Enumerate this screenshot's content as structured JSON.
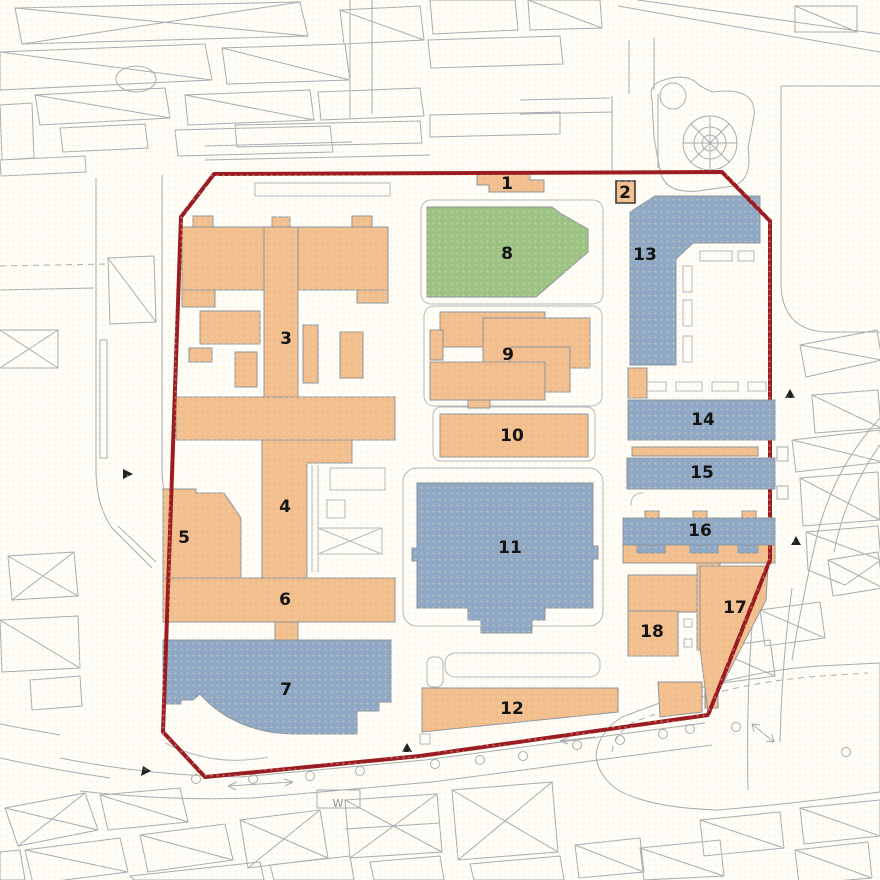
{
  "map": {
    "type": "site-plan",
    "background": "#FEFDF8",
    "colors": {
      "site_boundary": "#9B1B22",
      "building_orange": "#F3BE8D",
      "building_blue": "#8FA8C6",
      "building_green": "#9CC284",
      "building_outline": "#8F959D",
      "building_dark_outline": "#3A3A3A",
      "context_outline": "#A6AAAF",
      "label_text": "#141414",
      "dot_texture": "#EFE6B0"
    },
    "boundary": {
      "points": "214,174 722,172 770,221 770,560 708,715 420,756 205,777 163,732 181,217",
      "stroke_width": 4
    },
    "buildings": [
      {
        "id": "b1",
        "number": "1",
        "category": "orange",
        "label": {
          "x": 507,
          "y": 184
        },
        "shapes": [
          {
            "points": "477,173 530,173 530,180 544,180 544,192 489,192 489,185 477,185"
          }
        ]
      },
      {
        "id": "b2",
        "number": "2",
        "category": "orange",
        "dark_border": true,
        "label": {
          "x": 625,
          "y": 193
        },
        "shapes": [
          {
            "points": "616,181 635,181 635,203 616,203"
          }
        ]
      },
      {
        "id": "b3",
        "number": "3",
        "category": "orange",
        "label": {
          "x": 286,
          "y": 339
        },
        "shapes": [
          {
            "points": "182,227 268,227 268,290 182,290"
          },
          {
            "points": "193,216 213,216 213,227 193,227"
          },
          {
            "points": "298,227 388,227 388,290 298,290"
          },
          {
            "points": "352,216 372,216 372,227 352,227"
          },
          {
            "points": "264,227 298,227 298,398 264,398"
          },
          {
            "points": "272,217 290,217 290,227 272,227"
          },
          {
            "points": "182,290 215,290 215,307 182,307"
          },
          {
            "points": "357,290 388,290 388,303 357,303"
          },
          {
            "points": "200,311 260,311 260,344 200,344"
          },
          {
            "points": "189,348 212,348 212,362 189,362"
          },
          {
            "points": "235,352 257,352 257,387 235,387"
          },
          {
            "points": "303,325 318,325 318,383 303,383"
          },
          {
            "points": "340,332 363,332 363,378 340,378"
          },
          {
            "points": "176,397 395,397 395,440 176,440"
          }
        ]
      },
      {
        "id": "b4",
        "number": "4",
        "category": "orange",
        "label": {
          "x": 285,
          "y": 507
        },
        "shapes": [
          {
            "points": "262,440 352,440 352,463 307,463 307,578 262,578"
          }
        ]
      },
      {
        "id": "b5",
        "number": "5",
        "category": "orange",
        "label": {
          "x": 184,
          "y": 538
        },
        "shapes": [
          {
            "points": "163,489 196,489 196,493 224,493 241,518 241,578 163,578"
          }
        ]
      },
      {
        "id": "b6",
        "number": "6",
        "category": "orange",
        "label": {
          "x": 285,
          "y": 600
        },
        "shapes": [
          {
            "points": "163,578 395,578 395,622 163,622"
          },
          {
            "points": "275,622 298,622 298,641 275,641"
          }
        ]
      },
      {
        "id": "b7",
        "number": "7",
        "category": "blue",
        "label": {
          "x": 286,
          "y": 690
        },
        "shapes": [
          {
            "d": "M163,640 H391 V702 H379 V711 H357 V734 H295 C255,734 222,719 200,694 L193,700 H181 V704 H163 Z"
          }
        ]
      },
      {
        "id": "b8",
        "number": "8",
        "category": "green",
        "label": {
          "x": 507,
          "y": 254
        },
        "shapes": [
          {
            "points": "427,207 552,207 560,213 588,229 588,252 536,297 427,297"
          }
        ]
      },
      {
        "id": "b9",
        "number": "9",
        "category": "orange",
        "label": {
          "x": 508,
          "y": 355
        },
        "shapes": [
          {
            "points": "440,312 545,312 545,347 440,347"
          },
          {
            "points": "483,318 590,318 590,368 483,368"
          },
          {
            "points": "510,347 570,347 570,392 510,392"
          },
          {
            "points": "430,362 545,362 545,400 430,400"
          },
          {
            "points": "430,330 443,330 443,360 430,360"
          },
          {
            "points": "468,400 490,400 490,408 468,408"
          }
        ]
      },
      {
        "id": "b10",
        "number": "10",
        "category": "orange",
        "label": {
          "x": 512,
          "y": 436
        },
        "shapes": [
          {
            "points": "440,414 588,414 588,457 440,457"
          }
        ]
      },
      {
        "id": "b11",
        "number": "11",
        "category": "blue",
        "label": {
          "x": 510,
          "y": 548
        },
        "shapes": [
          {
            "d": "M417,483 H593 V546 H598 V559 H593 V608 H545 V620 H532 V633 H481 V620 H468 V608 H417 V561 H412 V548 H417 Z"
          }
        ]
      },
      {
        "id": "b12",
        "number": "12",
        "category": "orange",
        "label": {
          "x": 512,
          "y": 709
        },
        "shapes": [
          {
            "points": "422,688 618,688 618,712 422,732"
          },
          {
            "points": "658,682 702,682 702,712 660,717"
          },
          {
            "points": "705,689 718,689 718,708 705,708"
          }
        ]
      },
      {
        "id": "b13",
        "number": "13",
        "category": "blue",
        "label": {
          "x": 645,
          "y": 255
        },
        "shapes": [
          {
            "d": "M630,212 L655,196 H760 V243 H693 L676,259 V365 H630 Z"
          }
        ]
      },
      {
        "id": "b14",
        "number": "14",
        "category": "blue",
        "layer": "over",
        "label": {
          "x": 703,
          "y": 420
        },
        "shapes": [
          {
            "points": "628,400 775,400 775,440 628,440"
          }
        ]
      },
      {
        "id": "strip-14-15",
        "category": "orange",
        "shapes": [
          {
            "points": "632,447 758,447 758,456 632,456"
          }
        ]
      },
      {
        "id": "b15",
        "number": "15",
        "category": "blue",
        "layer": "over",
        "label": {
          "x": 702,
          "y": 473
        },
        "shapes": [
          {
            "points": "627,458 775,458 775,489 627,489"
          }
        ]
      },
      {
        "id": "tabs-above-16",
        "category": "orange",
        "shapes": [
          {
            "points": "645,511 659,511 659,518 645,518"
          },
          {
            "points": "693,511 707,511 707,518 693,518"
          },
          {
            "points": "742,511 756,511 756,518 742,518"
          }
        ]
      },
      {
        "id": "strip-below-16",
        "category": "orange",
        "shapes": [
          {
            "points": "623,545 775,545 775,563 623,563"
          }
        ]
      },
      {
        "id": "b16",
        "number": "16",
        "category": "blue",
        "layer": "over",
        "label": {
          "x": 700,
          "y": 531
        },
        "shapes": [
          {
            "points": "623,518 775,518 775,545 623,545"
          },
          {
            "points": "637,545 665,545 665,553 637,553"
          },
          {
            "points": "690,545 718,545 718,553 690,553"
          },
          {
            "points": "738,545 758,545 758,553 738,553"
          }
        ]
      },
      {
        "id": "patch-left-of-14",
        "category": "orange",
        "shapes": [
          {
            "points": "628,368 647,368 647,398 628,398"
          }
        ]
      },
      {
        "id": "b17",
        "number": "17",
        "category": "orange",
        "label": {
          "x": 735,
          "y": 608
        },
        "shapes": [
          {
            "points": "628,575 714,575 714,612 628,612"
          },
          {
            "points": "697,563 720,563 720,650 697,650"
          },
          {
            "d": "M700,566 H768 L766,600 L708,712 L700,648 Z"
          }
        ]
      },
      {
        "id": "b18",
        "number": "18",
        "category": "orange",
        "label": {
          "x": 652,
          "y": 632
        },
        "shapes": [
          {
            "points": "628,611 678,611 678,656 628,656"
          }
        ]
      }
    ],
    "context_labels": [
      {
        "text": "W",
        "x": 338,
        "y": 803
      }
    ]
  }
}
